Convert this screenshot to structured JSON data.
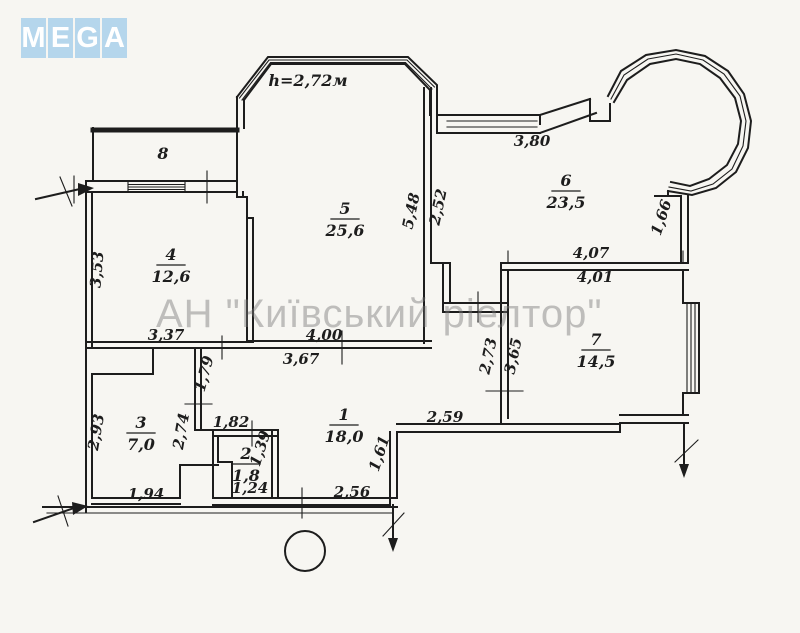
{
  "logo": {
    "letters": [
      "M",
      "E",
      "G",
      "A"
    ],
    "tile_color": "#b5d6ec",
    "letter_color": "#ffffff"
  },
  "watermark": {
    "text": "АН \"Київський ріелтор\"",
    "color": "#9a9a9a"
  },
  "plan": {
    "ceiling_height_note": "h=2,72м",
    "note_position": {
      "x": 308,
      "y": 86
    },
    "rooms": [
      {
        "number": "1",
        "area": "18,0",
        "x": 344,
        "y": 420
      },
      {
        "number": "2",
        "area": "1,8",
        "x": 246,
        "y": 459
      },
      {
        "number": "3",
        "area": "7,0",
        "x": 141,
        "y": 428
      },
      {
        "number": "4",
        "area": "12,6",
        "x": 171,
        "y": 260
      },
      {
        "number": "5",
        "area": "25,6",
        "x": 345,
        "y": 214
      },
      {
        "number": "6",
        "area": "23,5",
        "x": 566,
        "y": 186
      },
      {
        "number": "7",
        "area": "14,5",
        "x": 596,
        "y": 345
      },
      {
        "number": "8",
        "area": "",
        "x": 163,
        "y": 159
      }
    ],
    "dimensions": [
      {
        "text": "3,80",
        "x": 532,
        "y": 146,
        "rot": 0
      },
      {
        "text": "1,66",
        "x": 666,
        "y": 219,
        "rot": -72
      },
      {
        "text": "4,07",
        "x": 591,
        "y": 258,
        "rot": 0
      },
      {
        "text": "4,01",
        "x": 595,
        "y": 282,
        "rot": 0
      },
      {
        "text": "5,48",
        "x": 416,
        "y": 212,
        "rot": -78
      },
      {
        "text": "2,52",
        "x": 443,
        "y": 208,
        "rot": -78
      },
      {
        "text": "3,53",
        "x": 102,
        "y": 270,
        "rot": -85
      },
      {
        "text": "3,37",
        "x": 166,
        "y": 340,
        "rot": 0
      },
      {
        "text": "4,00",
        "x": 324,
        "y": 340,
        "rot": 0
      },
      {
        "text": "3,67",
        "x": 301,
        "y": 364,
        "rot": 0
      },
      {
        "text": "1,79",
        "x": 209,
        "y": 375,
        "rot": -75
      },
      {
        "text": "2,73",
        "x": 493,
        "y": 357,
        "rot": -78
      },
      {
        "text": "3,65",
        "x": 518,
        "y": 357,
        "rot": -78
      },
      {
        "text": "2,59",
        "x": 445,
        "y": 422,
        "rot": 0
      },
      {
        "text": "2,93",
        "x": 101,
        "y": 433,
        "rot": -80
      },
      {
        "text": "2,74",
        "x": 186,
        "y": 432,
        "rot": -80
      },
      {
        "text": "1,82",
        "x": 231,
        "y": 427,
        "rot": 0
      },
      {
        "text": "1,39",
        "x": 265,
        "y": 450,
        "rot": -72
      },
      {
        "text": "1,61",
        "x": 384,
        "y": 455,
        "rot": -72
      },
      {
        "text": "1,94",
        "x": 146,
        "y": 499,
        "rot": 0
      },
      {
        "text": "1,24",
        "x": 250,
        "y": 493,
        "rot": 0
      },
      {
        "text": "2,56",
        "x": 352,
        "y": 497,
        "rot": 0
      }
    ]
  },
  "colors": {
    "ink": "#1d1d1d",
    "background": "#f7f6f2"
  }
}
